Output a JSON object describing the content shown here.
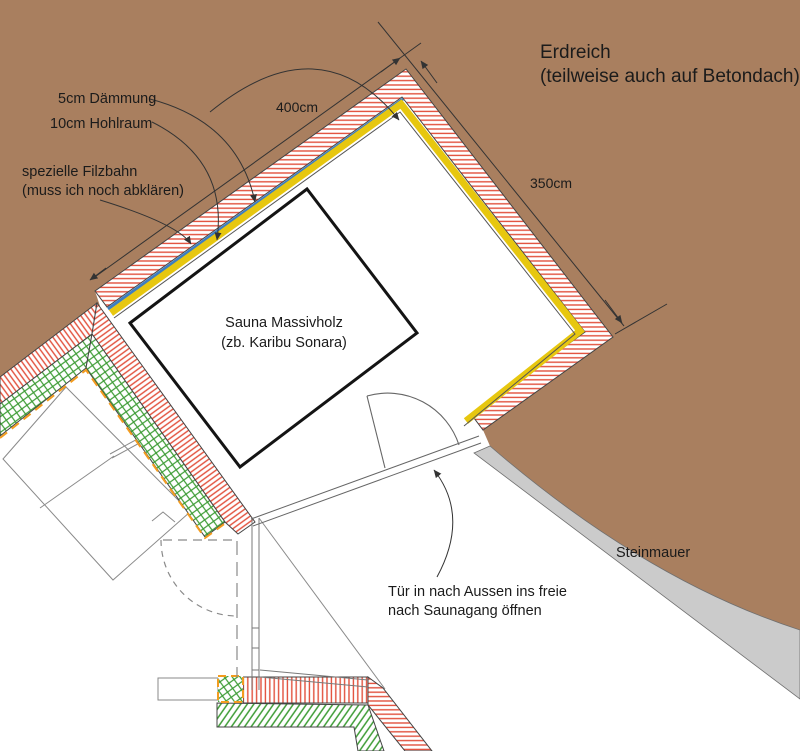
{
  "drawing": {
    "type": "floor-plan-sketch",
    "subject": "Sauna installation plan with insulation layers, earth cover and stone wall"
  },
  "labels": {
    "insulation": "5cm Dämmung",
    "cavity": "10cm Hohlraum",
    "felt_line1": "spezielle Filzbahn",
    "felt_line2": "(muss ich noch abklären)",
    "earth_line1": "Erdreich",
    "earth_line2": "(teilweise auch auf Betondach)",
    "dim_width": "400cm",
    "dim_depth": "350cm",
    "sauna_line1": "Sauna Massivholz",
    "sauna_line2": "(zb. Karibu Sonara)",
    "stone_wall": "Steinmauer",
    "door_line1": "Tür in nach Aussen ins freie",
    "door_line2": "nach Saunagang öffnen"
  },
  "colors": {
    "earth_brown": "#a97f5f",
    "stone_gray": "#cbcbcb",
    "insulation_yellow": "#e7c70f",
    "felt_blue": "#3d7ec2",
    "hatch_red": "#e2503c",
    "hatch_green": "#3d9c35",
    "dash_orange": "#f39c1f",
    "line_dark": "#333333",
    "line_gray": "#7a7a7a"
  }
}
